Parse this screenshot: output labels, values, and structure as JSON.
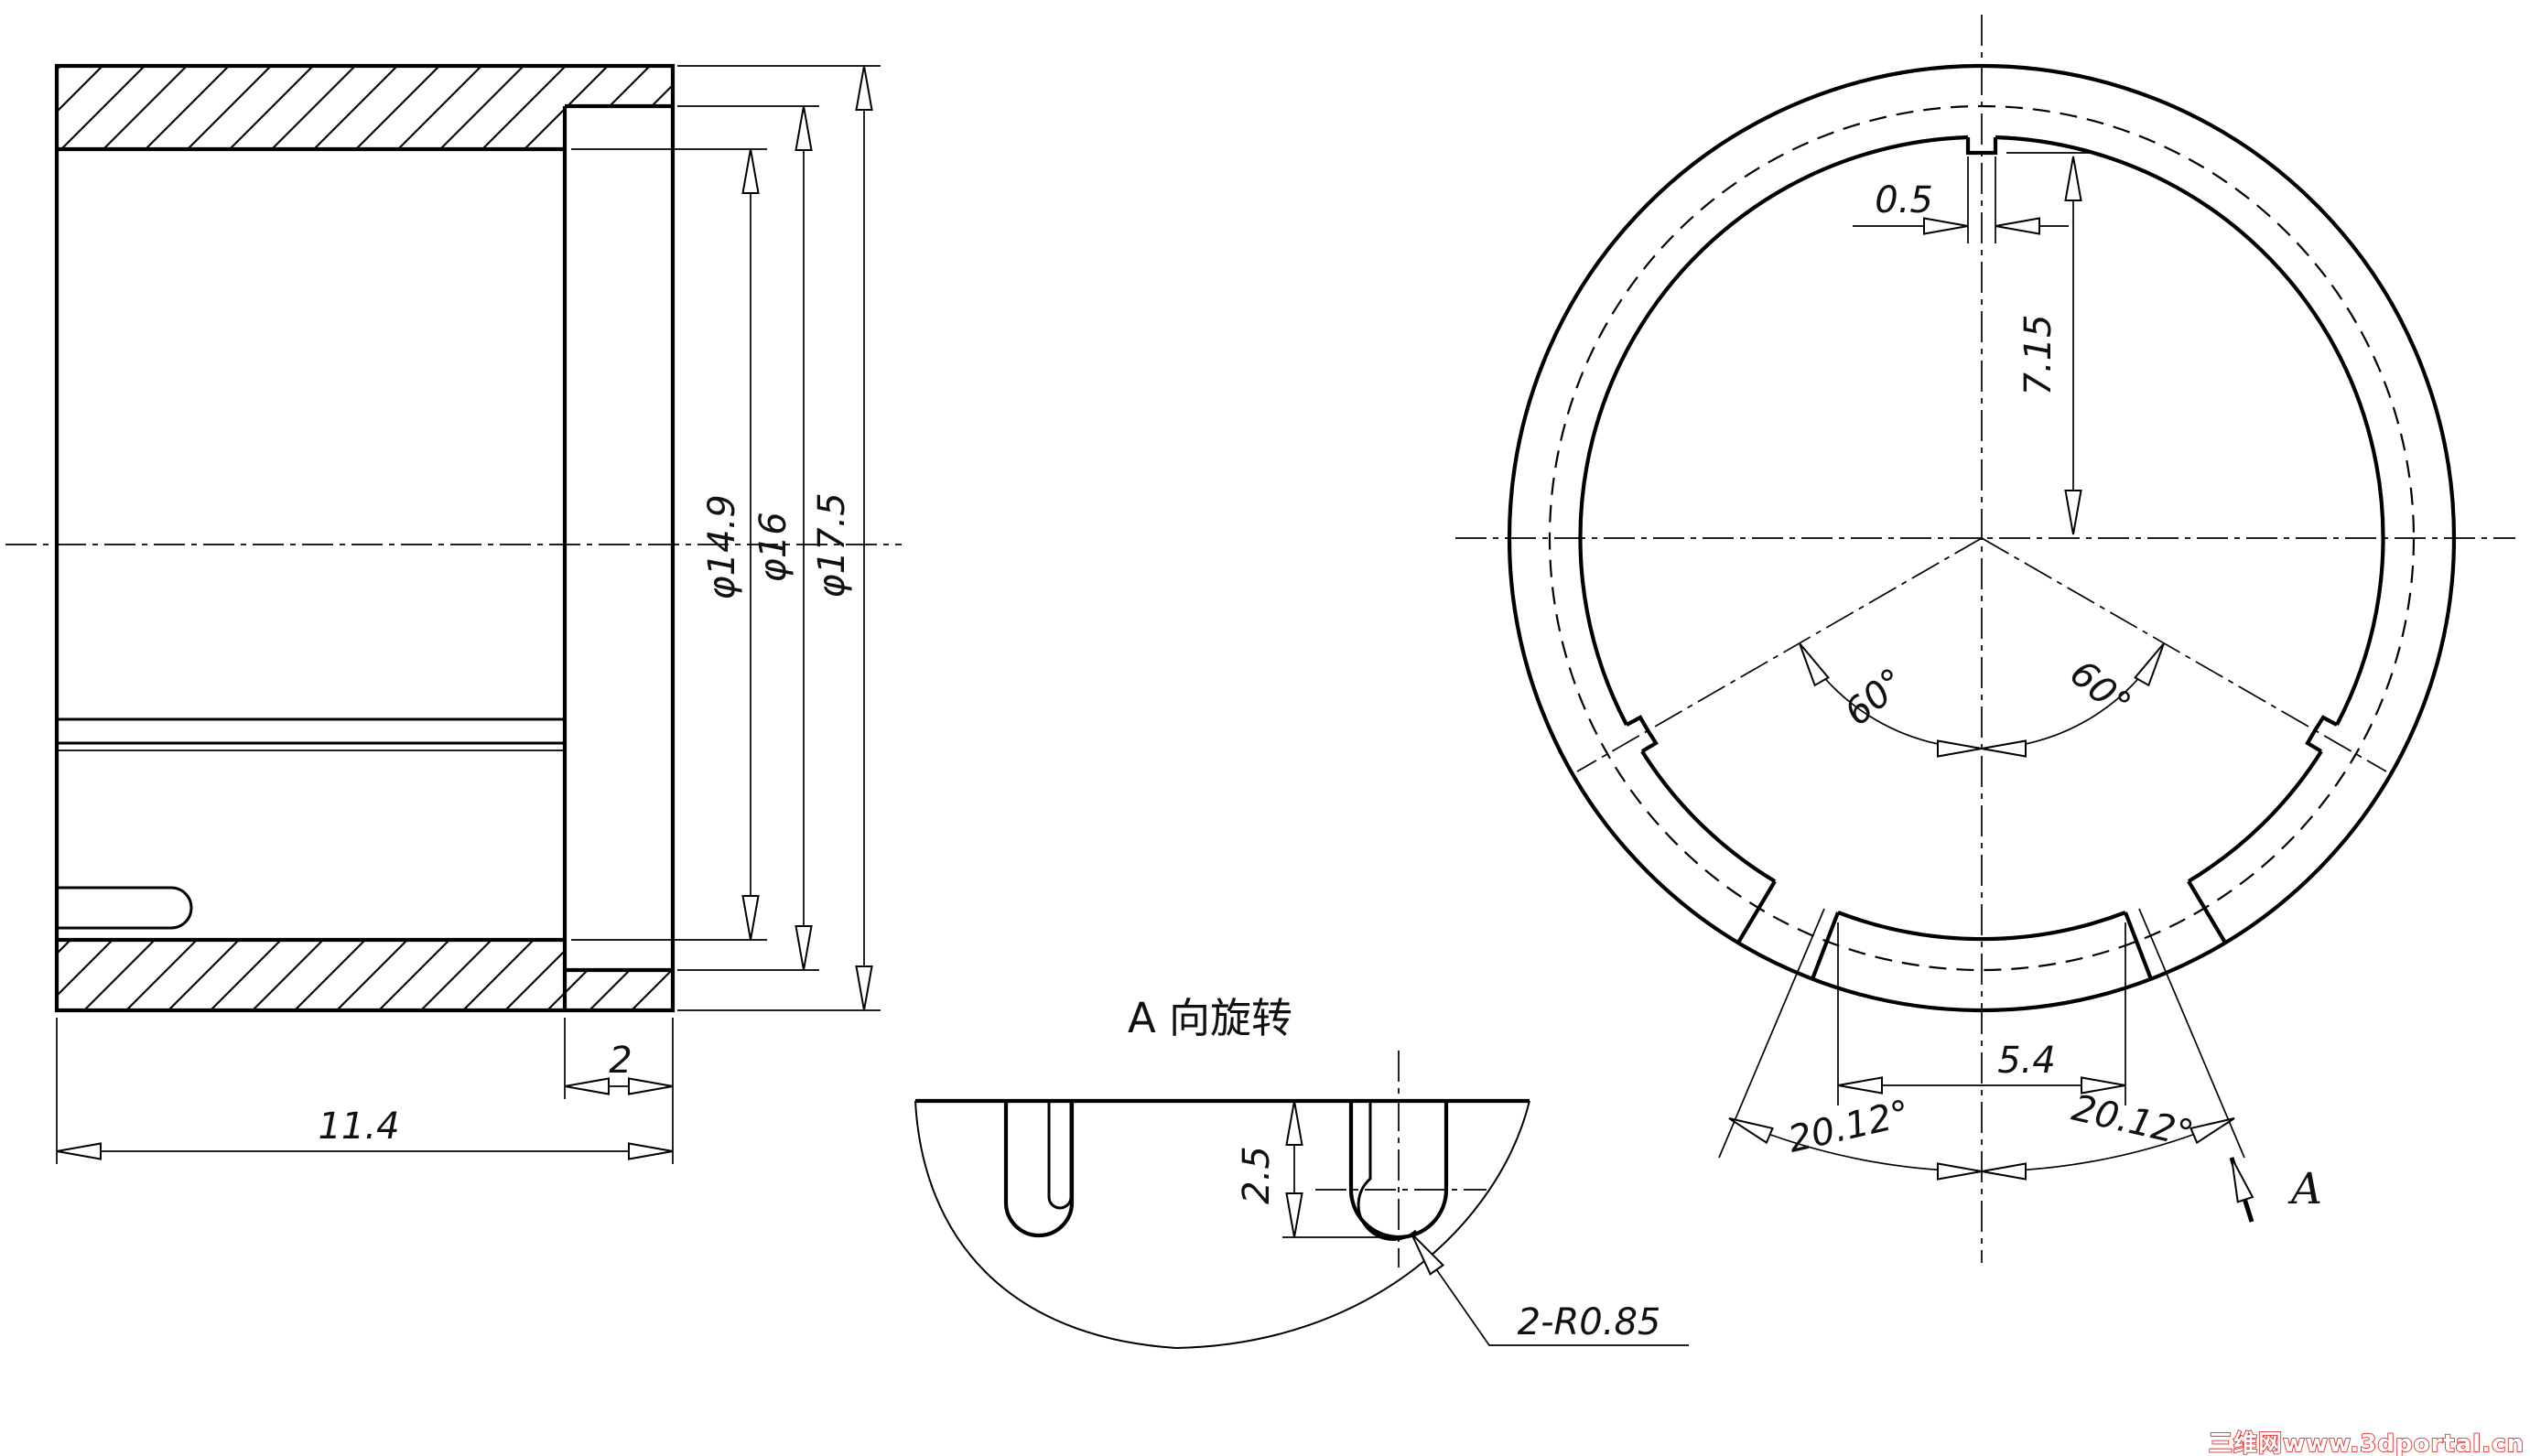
{
  "page": {
    "background": "#ffffff",
    "line_color": "#000000",
    "watermark_color": "#e0312e"
  },
  "section_view": {
    "dim_total_length": "11.4",
    "dim_flange_width": "2",
    "dim_bore_diameter": "φ14.9",
    "dim_counterbore_diameter": "φ16",
    "dim_outer_diameter": "φ17.5"
  },
  "detail_view": {
    "title": "A 向旋转",
    "dim_slot_depth": "2.5",
    "leader_slot_radius": "2-R0.85"
  },
  "front_view": {
    "dim_tab_width": "0.5",
    "dim_tab_depth": "7.15",
    "dim_slot_gap": "5.4",
    "dim_slot_angle_left": "20.12°",
    "dim_slot_angle_right": "20.12°",
    "dim_tab_angle_left": "60°",
    "dim_tab_angle_right": "60°",
    "view_arrow_label": "A"
  },
  "watermark": {
    "text": "三维网www.3dportal.cn"
  }
}
